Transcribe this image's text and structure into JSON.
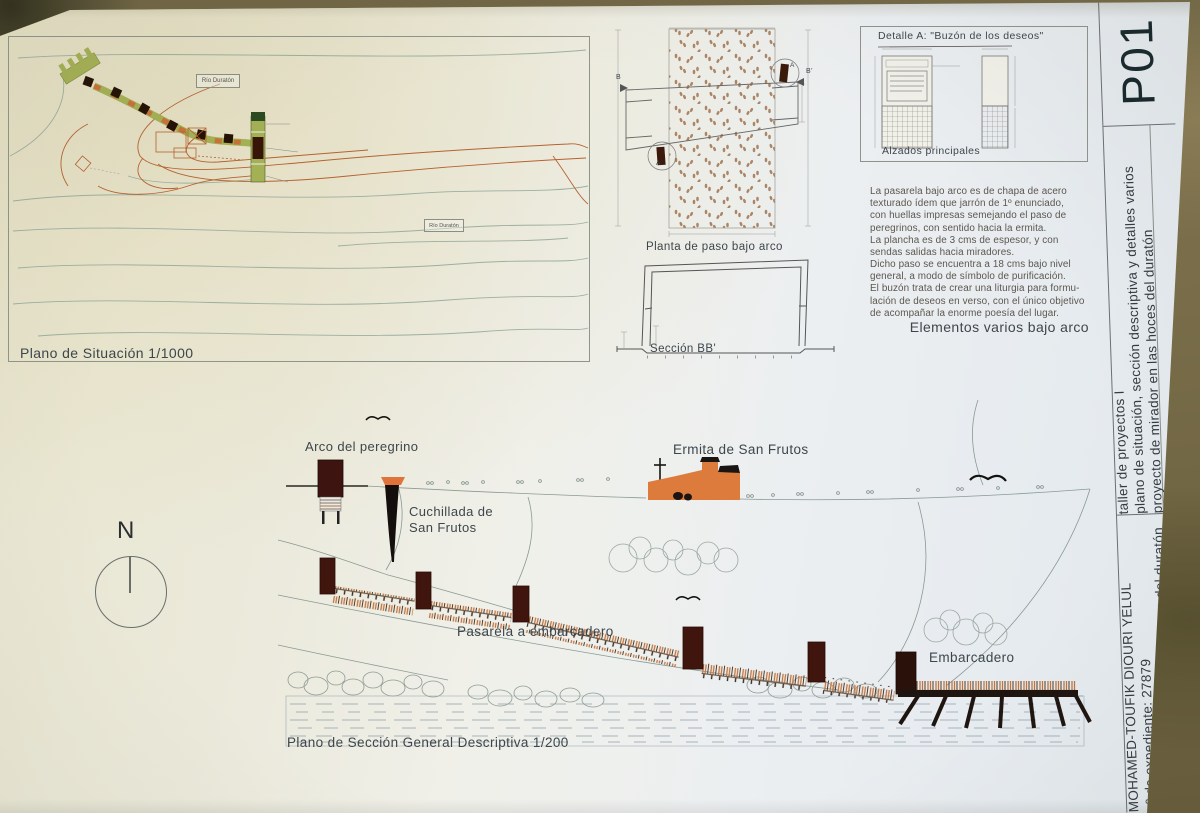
{
  "sheet_code": "P01",
  "titleblock": {
    "course": "taller de proyectos I",
    "sheet_title": "plano de situación, sección descriptiva y detalles varios",
    "project": "proyecto de mirador en las hoces del duratón",
    "team_line": "Equipo Docente: Carlos González Bravo, Juan Antonio Rodríguez Fernandez; Loreto Barrios Rodríguez",
    "student": "MOHAMED-TOUFIK DIOURI YELUL",
    "record_number": "nº de expediente: 27879",
    "project_repeat": "proyecto de mirador en las hoces del duratón"
  },
  "site_plan": {
    "caption": "Plano de Situación 1/1000",
    "river_label_top": "Río Duratón",
    "river_label_bottom": "Río Duratón"
  },
  "under_arch": {
    "plan_caption": "Planta de paso bajo arco",
    "section_caption": "Sección BB'",
    "detail_marker": "A",
    "detail_marker2": "A",
    "section_marker_left": "B",
    "section_marker_right": "B'"
  },
  "detail_a": {
    "title": "Detalle A: \"Buzón de los deseos\"",
    "caption": "Alzados principales"
  },
  "notes": {
    "body": "La pasarela bajo arco es de chapa de acero\ntexturado ídem que jarrón de 1º enunciado,\ncon huellas impresas semejando el paso de\nperegrinos, con sentido hacia la ermita.\nLa plancha es de 3 cms de espesor, y con\nsendas salidas hacia miradores.\nDicho paso se encuentra a 18 cms bajo nivel\ngeneral, a modo de símbolo de purificación.\nEl buzón trata de crear una liturgia para formu-\nlación de deseos en verso, con el único objetivo\nde acompañar la enorme poesía del lugar.",
    "heading": "Elementos varios bajo arco"
  },
  "general_section": {
    "caption": "Plano de Sección General Descriptiva 1/200",
    "north": "N",
    "labels": {
      "arco": "Arco del peregrino",
      "cuchillada": "Cuchillada de\nSan Frutos",
      "ermita": "Ermita de San Frutos",
      "pasarela": "Pasarela a embarcadero",
      "embarcadero": "Embarcadero"
    }
  },
  "colors": {
    "building_orange": "#dd7b3c",
    "timber_dark": "#3d1410",
    "path_green": "#a4b054",
    "contour_orange": "#b5622f",
    "contour_green": "#9caf9f"
  }
}
